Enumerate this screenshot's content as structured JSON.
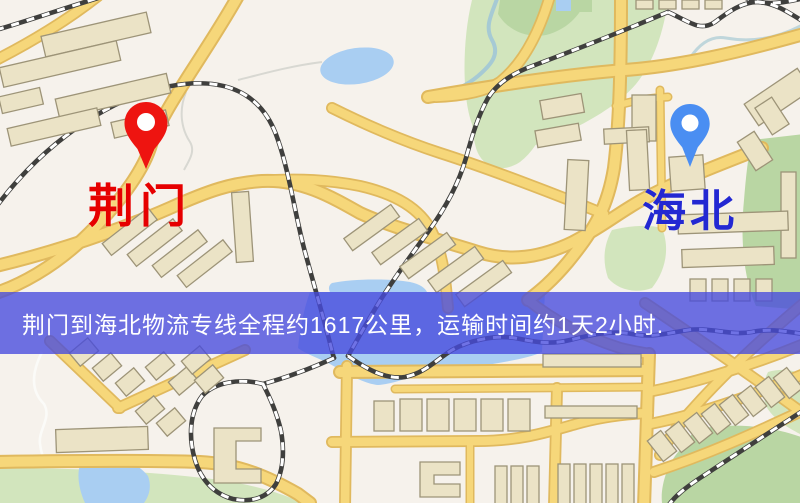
{
  "map": {
    "origin": {
      "label": "荆门"
    },
    "destination": {
      "label": "海北"
    },
    "banner": {
      "text": "荆门到海北物流专线全程约1617公里，运输时间约1天2小时."
    },
    "icons": {
      "origin_pin": "red-map-pin-icon",
      "destination_pin": "blue-map-pin-icon"
    },
    "colors": {
      "origin-color": "#e60000",
      "dest-color": "#2328d2",
      "origin-pin": "#ee1410",
      "dest-pin": "#4a8ef2",
      "banner-bg": "rgba(70,74,222,0.78)",
      "banner-text": "#ffffff",
      "road-fill": "#f6d77a",
      "road-casing": "#e0b95e",
      "water": "#a9cef2",
      "park": "#d2e5bd",
      "building": "#ebe3c6",
      "rail": "#3f3f3d"
    }
  }
}
